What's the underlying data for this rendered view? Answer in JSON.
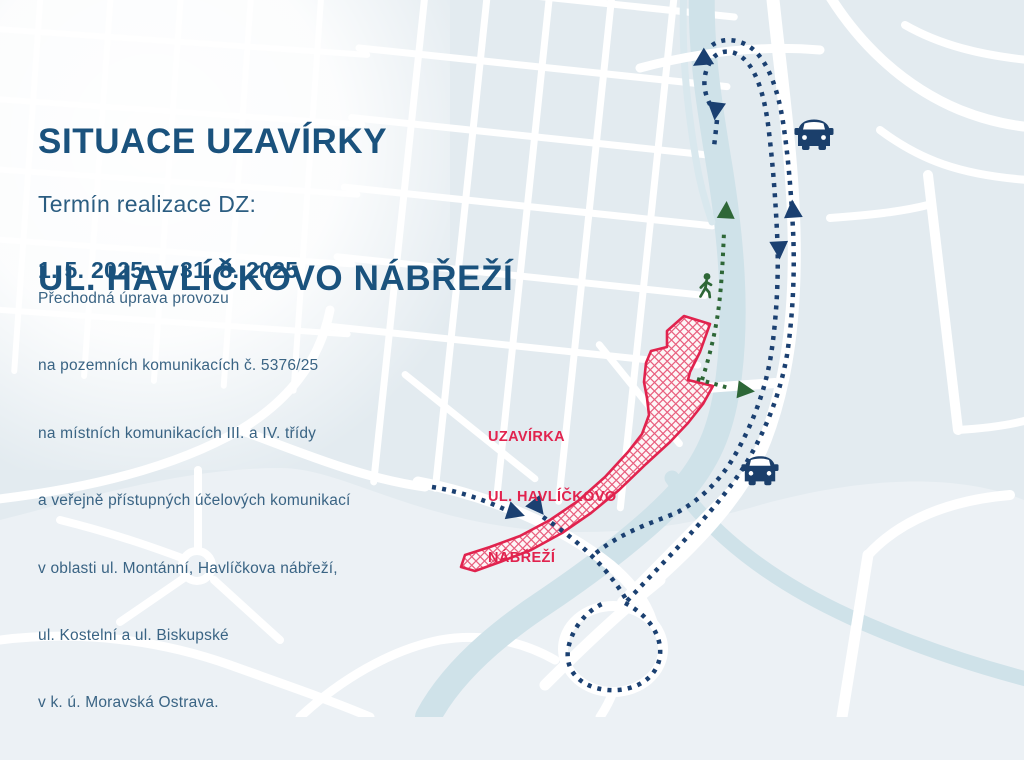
{
  "header": {
    "title_line1": "SITUACE UZAVÍRKY",
    "title_line2": "UL. HAVLÍČKOVO NÁBŘEŽÍ",
    "term_label": "Termín realizace DZ:",
    "term_dates": "1. 5. 2025 — 31. 8. 2025"
  },
  "description": {
    "lines": [
      "Přechodná úprava provozu",
      "na pozemních komunikacích č. 5376/25",
      "na místních komunikacích III. a IV. třídy",
      "a veřejně přístupných účelových komunikací",
      "v oblasti ul. Montánní, Havlíčkova nábřeží,",
      "ul. Kostelní a ul. Biskupské",
      "v k. ú. Moravská Ostrava."
    ]
  },
  "map": {
    "closure_label": {
      "line1": "UZAVÍRKA",
      "line2": "UL. HAVLÍČKOVO",
      "line3": "NÁBŘEŽÍ"
    },
    "icons": {
      "car": "car-icon",
      "pedestrian": "pedestrian-icon",
      "detour_arrow": "arrowhead-icon"
    },
    "colors": {
      "title_blue": "#1A527D",
      "closure_red": "#E1234E",
      "detour_navy": "#1B4071",
      "pedestrian_green": "#2E6737",
      "map_background": "#ECF1F5",
      "district_fill": "#E3EBF0",
      "river_blue": "#CFE2E9",
      "road_white": "#FFFFFF"
    }
  }
}
